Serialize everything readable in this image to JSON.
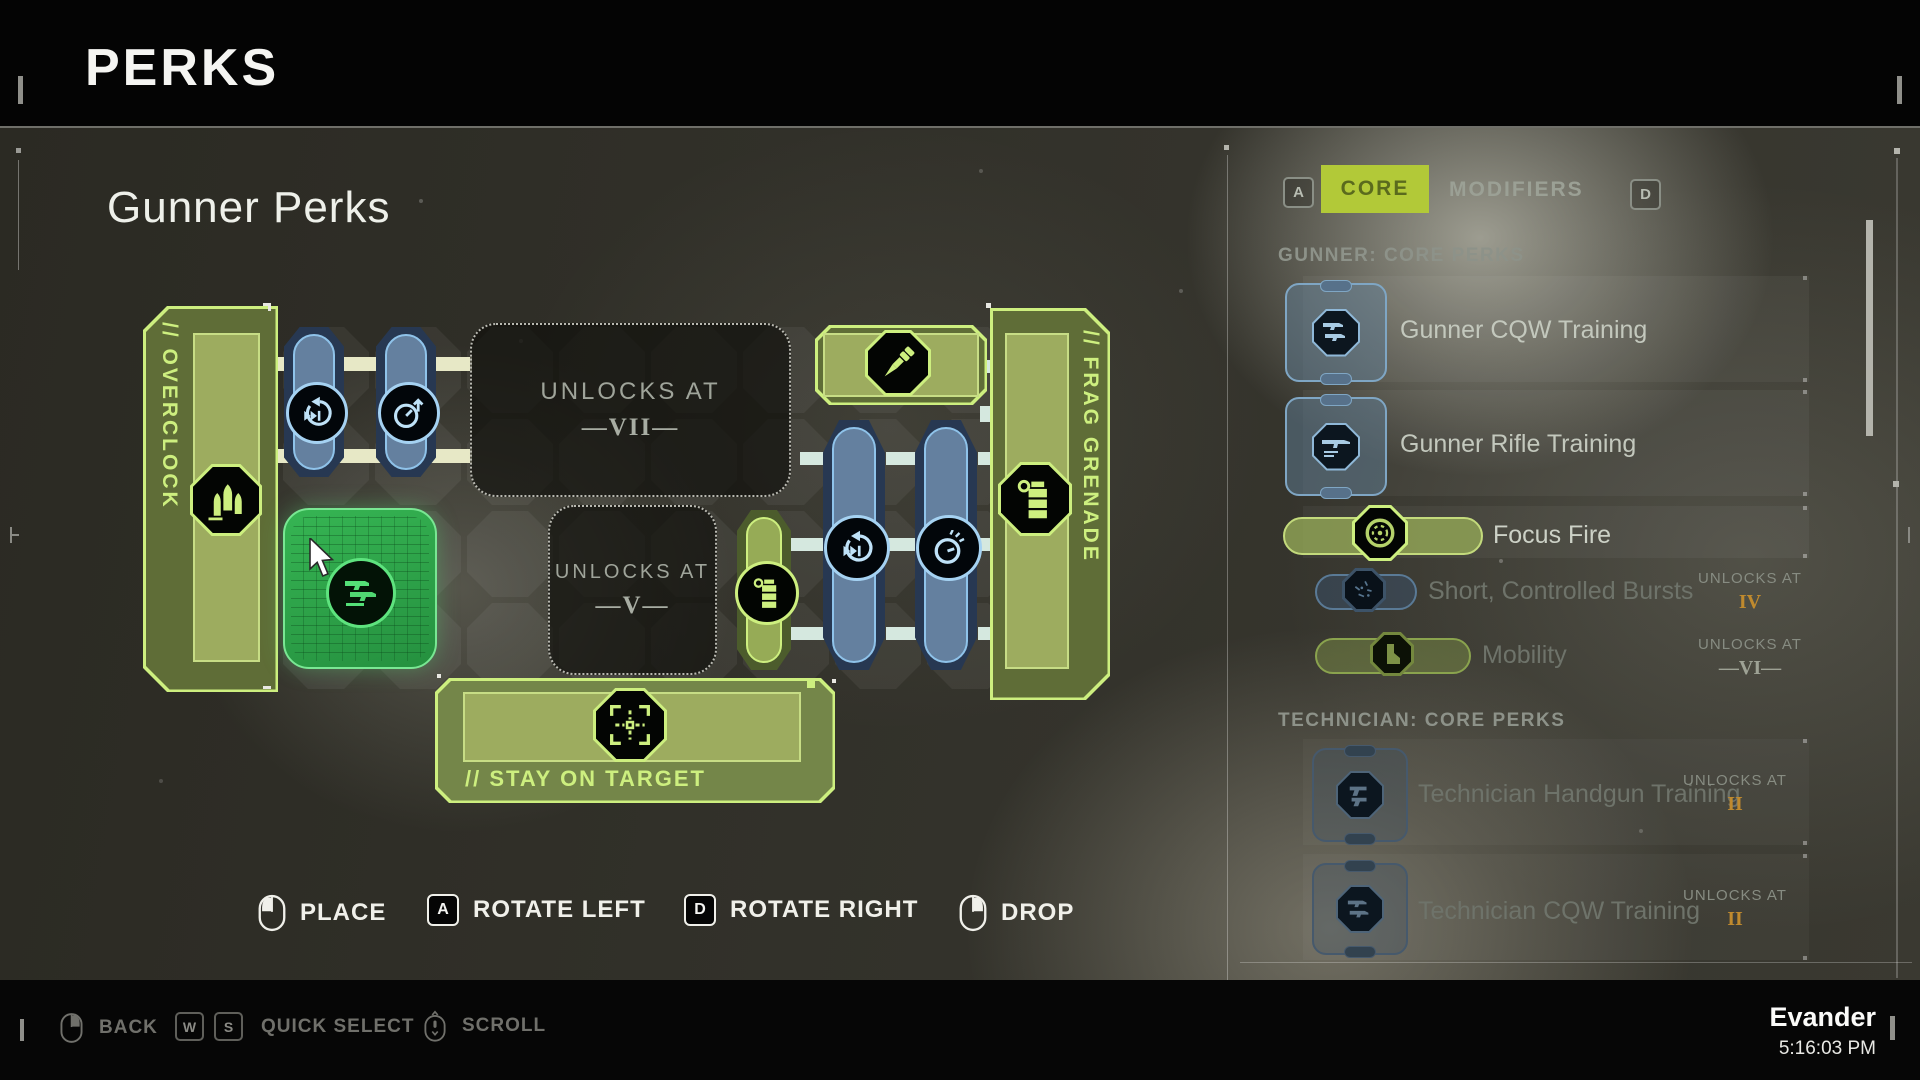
{
  "header": {
    "title": "PERKS"
  },
  "board": {
    "heading": "Gunner Perks",
    "pieces": {
      "overclock": {
        "label": "// OVERCLOCK",
        "icon": "bullets-icon"
      },
      "frag_grenade": {
        "label": "// FRAG GRENADE",
        "icon": "grenade-icon"
      },
      "stay_on_target": {
        "label": "// STAY ON TARGET",
        "icon": "crosshair-icon"
      },
      "top_module": {
        "icon": "dart-icon"
      },
      "selected_module": {
        "icon": "guns-stack-icon",
        "state": "placing"
      },
      "mid_green_capsule": {
        "icon": "grenade-icon"
      },
      "blue_capsules": [
        {
          "icon": "reload-cycle-icon"
        },
        {
          "icon": "timer-up-icon"
        },
        {
          "icon": "reload-cycle-icon"
        },
        {
          "icon": "timer-lines-icon"
        }
      ]
    },
    "unlock_vii": {
      "label": "UNLOCKS AT",
      "level": "—VII—"
    },
    "unlock_v": {
      "label": "UNLOCKS AT",
      "level": "—V—"
    }
  },
  "hints": {
    "place": {
      "label": "PLACE",
      "input": "mouse-left"
    },
    "rotate_left": {
      "label": "ROTATE LEFT",
      "key": "A"
    },
    "rotate_right": {
      "label": "ROTATE RIGHT",
      "key": "D"
    },
    "drop": {
      "label": "DROP",
      "input": "mouse-right"
    }
  },
  "panel": {
    "tab_key_left": "A",
    "tab_key_right": "D",
    "tabs": [
      {
        "label": "CORE",
        "active": true
      },
      {
        "label": "MODIFIERS",
        "active": false
      }
    ],
    "unlocks_at_label": "UNLOCKS AT",
    "sections": [
      {
        "title": "GUNNER: CORE PERKS",
        "rows": [
          {
            "label": "Gunner CQW Training",
            "icon": "cqw-guns-icon",
            "state": "available"
          },
          {
            "label": "Gunner Rifle Training",
            "icon": "rifle-icon",
            "state": "available"
          },
          {
            "label": "Focus Fire",
            "icon": "ammo-drum-icon",
            "state": "equipped"
          },
          {
            "label": "Short, Controlled Bursts",
            "icon": "burst-icon",
            "state": "locked",
            "unlocks_at": "IV"
          },
          {
            "label": "Mobility",
            "icon": "boot-icon",
            "state": "locked",
            "unlocks_at": "—VI—"
          }
        ]
      },
      {
        "title": "TECHNICIAN: CORE PERKS",
        "rows": [
          {
            "label": "Technician Handgun Training",
            "icon": "handgun-icon",
            "state": "locked",
            "unlocks_at": "II"
          },
          {
            "label": "Technician CQW Training",
            "icon": "cqw-guns-icon",
            "state": "locked",
            "unlocks_at": "II"
          }
        ]
      }
    ]
  },
  "footer": {
    "back": "BACK",
    "key_w": "W",
    "key_s": "S",
    "quick_select": "QUICK SELECT",
    "scroll": "SCROLL",
    "player": "Evander",
    "time": "5:16:03 PM"
  },
  "colors": {
    "accent_green": "#cdef7f",
    "selected_green": "#2fae4c",
    "tab_active_bg": "#b2c938",
    "capsule_blue": "#8fc3ea",
    "unlock_gold": "#c08a2e"
  }
}
